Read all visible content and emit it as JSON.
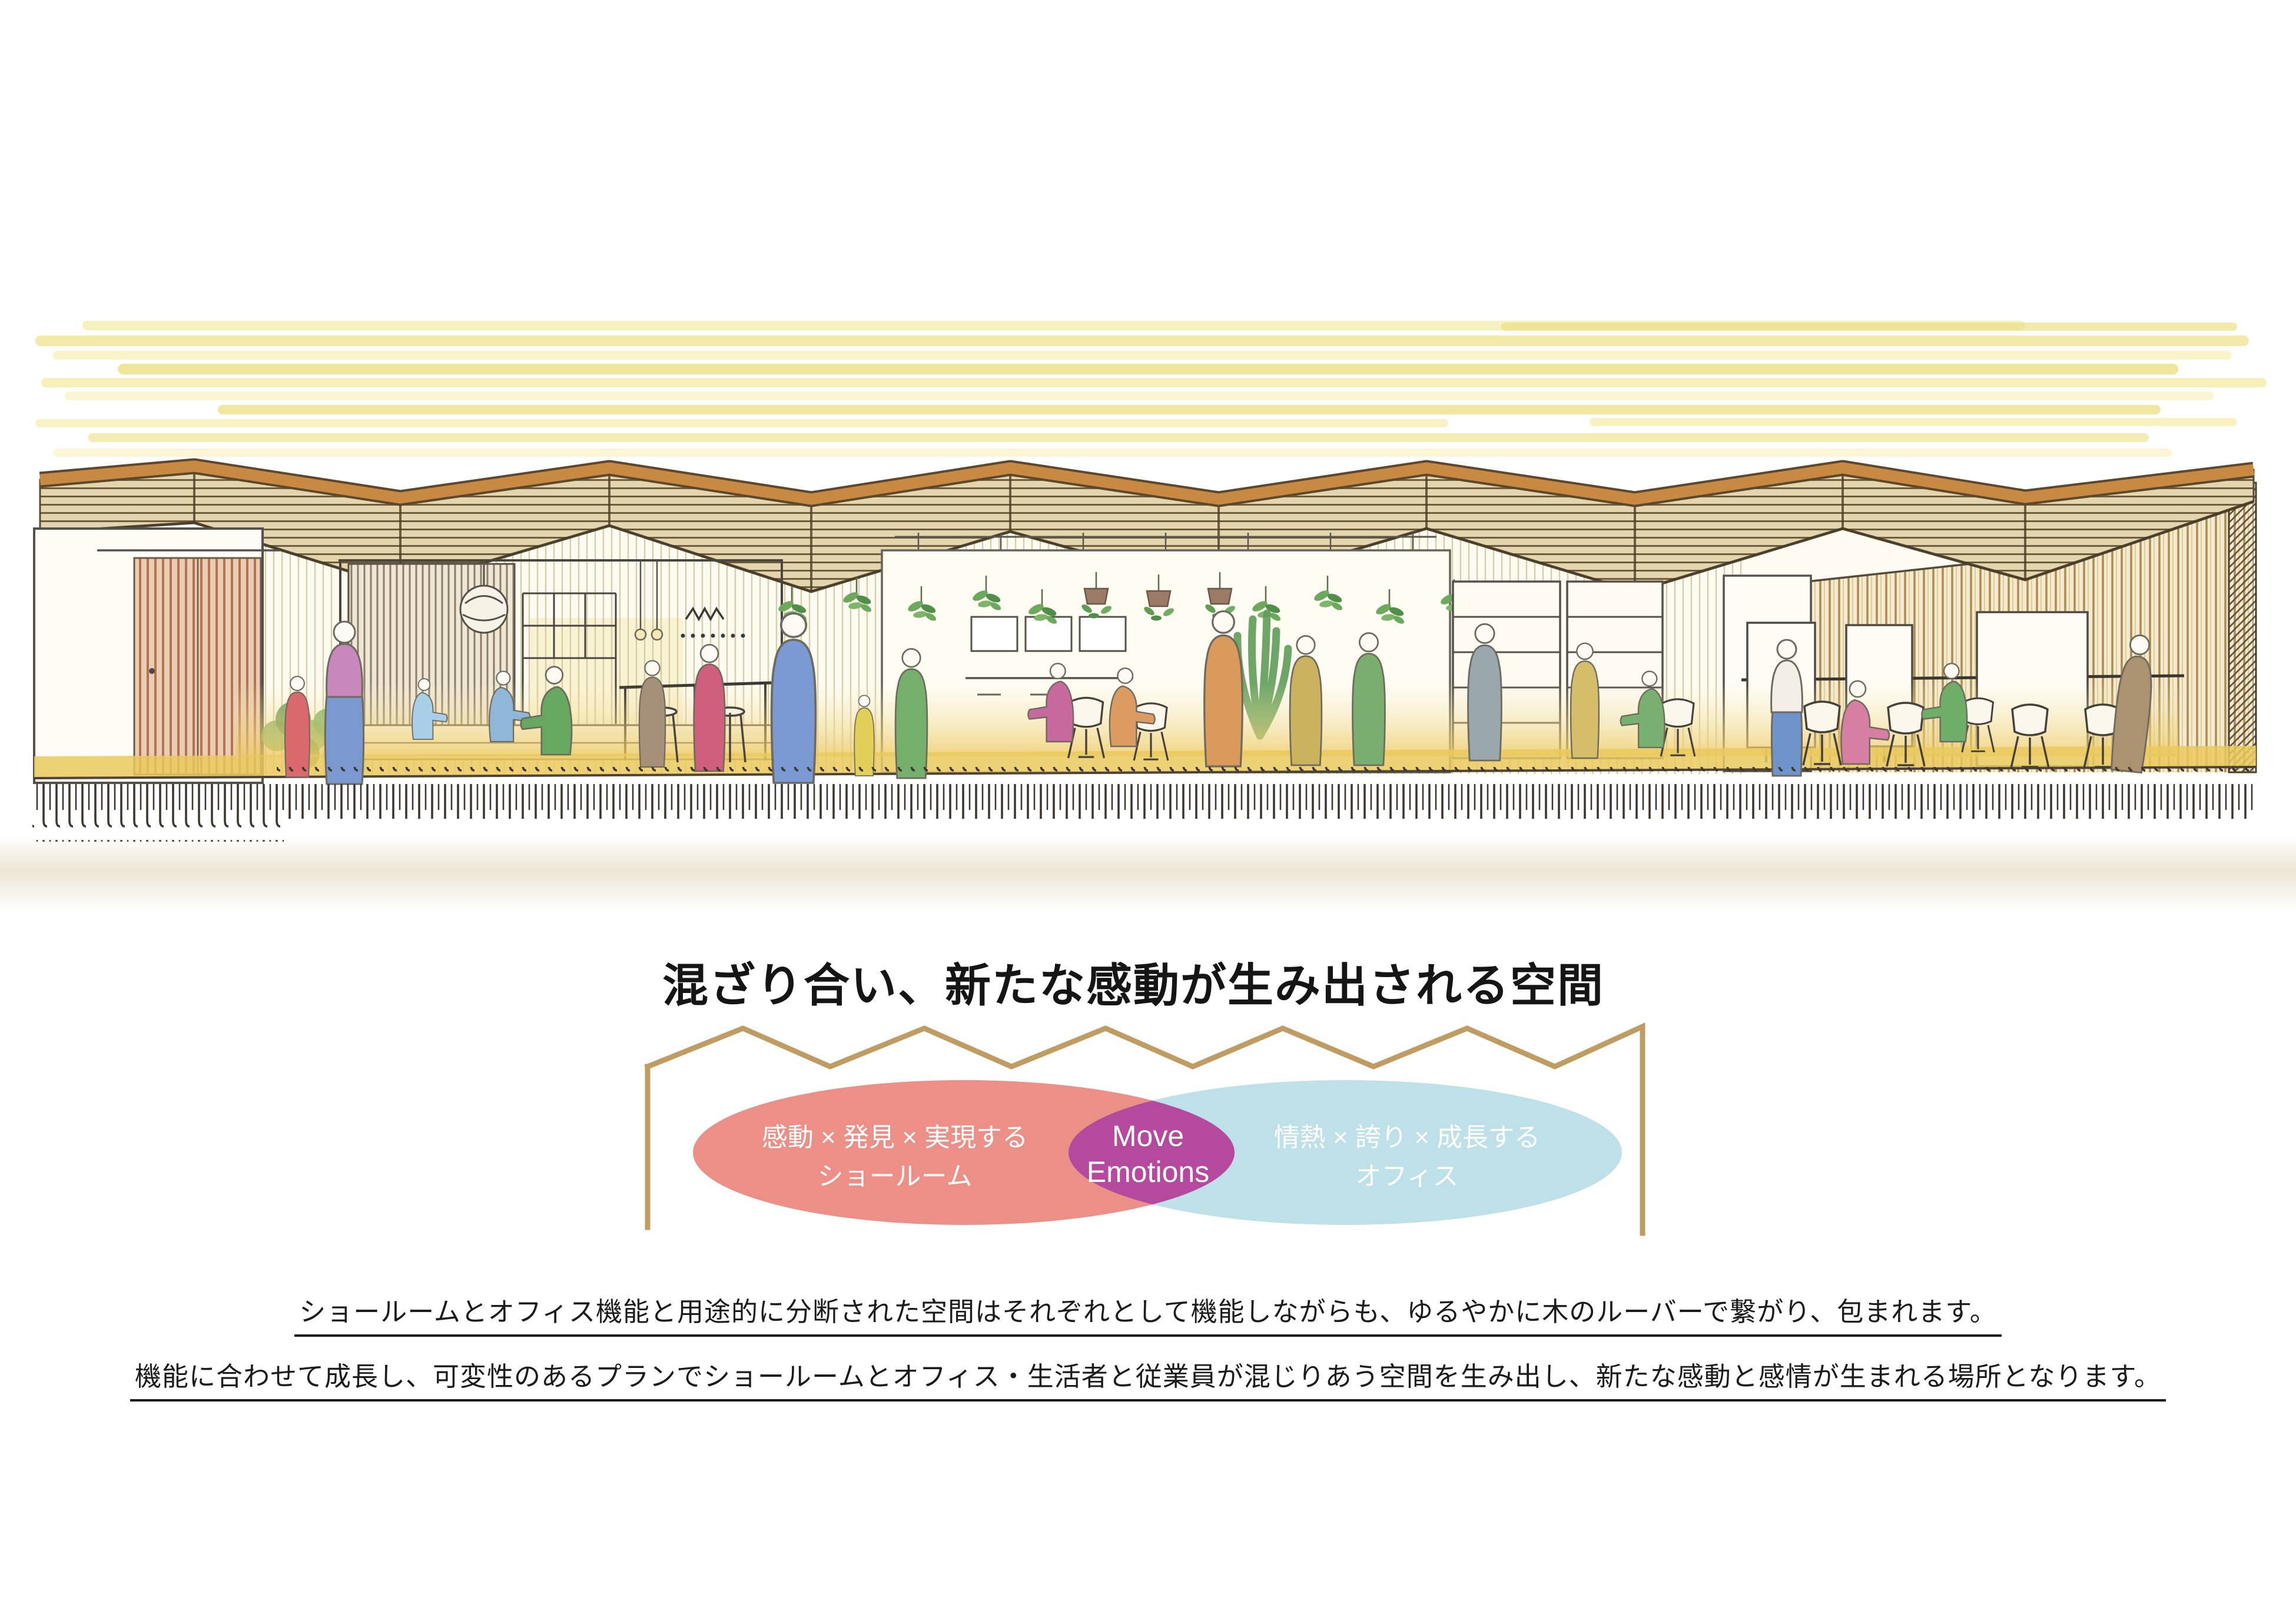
{
  "page": {
    "kind": "presentation-slide",
    "background": "#ffffff"
  },
  "headline": {
    "title": "混ざり合い、新たな感動が生み出される空間",
    "color": "#151515"
  },
  "venn_diagram": {
    "frame_color": "#bf9c62",
    "text_color": "#ffffff",
    "left": {
      "label_line1": "感動 × 発見 × 実現する",
      "label_line2": "ショールーム",
      "fill": "#ec8f87"
    },
    "overlap": {
      "label_line1": "Move",
      "label_line2": "Emotions",
      "fill": "#b4499d"
    },
    "right": {
      "label_line1": "情熱 × 誇り × 成長する",
      "label_line2": "オフィス",
      "fill": "#bee0e9"
    }
  },
  "description": {
    "line1": "ショールームとオフィス機能と用途的に分断された空間はそれぞれとして機能しながらも、ゆるやかに木のルーバーで繋がり、包まれます。",
    "line2": "機能に合わせて成長し、可変性のあるプランでショールームとオフィス・生活者と従業員が混じりあう空間を生み出し、新たな感動と感情が生まれる場所となります。"
  },
  "sketch": {
    "caption": "hand-drawn interior section perspective: showroom and office under a folded wooden louver roof",
    "palette": {
      "sky_yellow": "#f1e48a",
      "roof_ridge_orange": "#c88a43",
      "roof_slat_brown": "#6e5c3d",
      "louver_gold": "#ad8d50",
      "door_wood_red": "#b5724d",
      "floor_yellow": "#eac95e",
      "ground_shadow": "#e7ddc6",
      "plant_green": "#6ca95c"
    }
  }
}
